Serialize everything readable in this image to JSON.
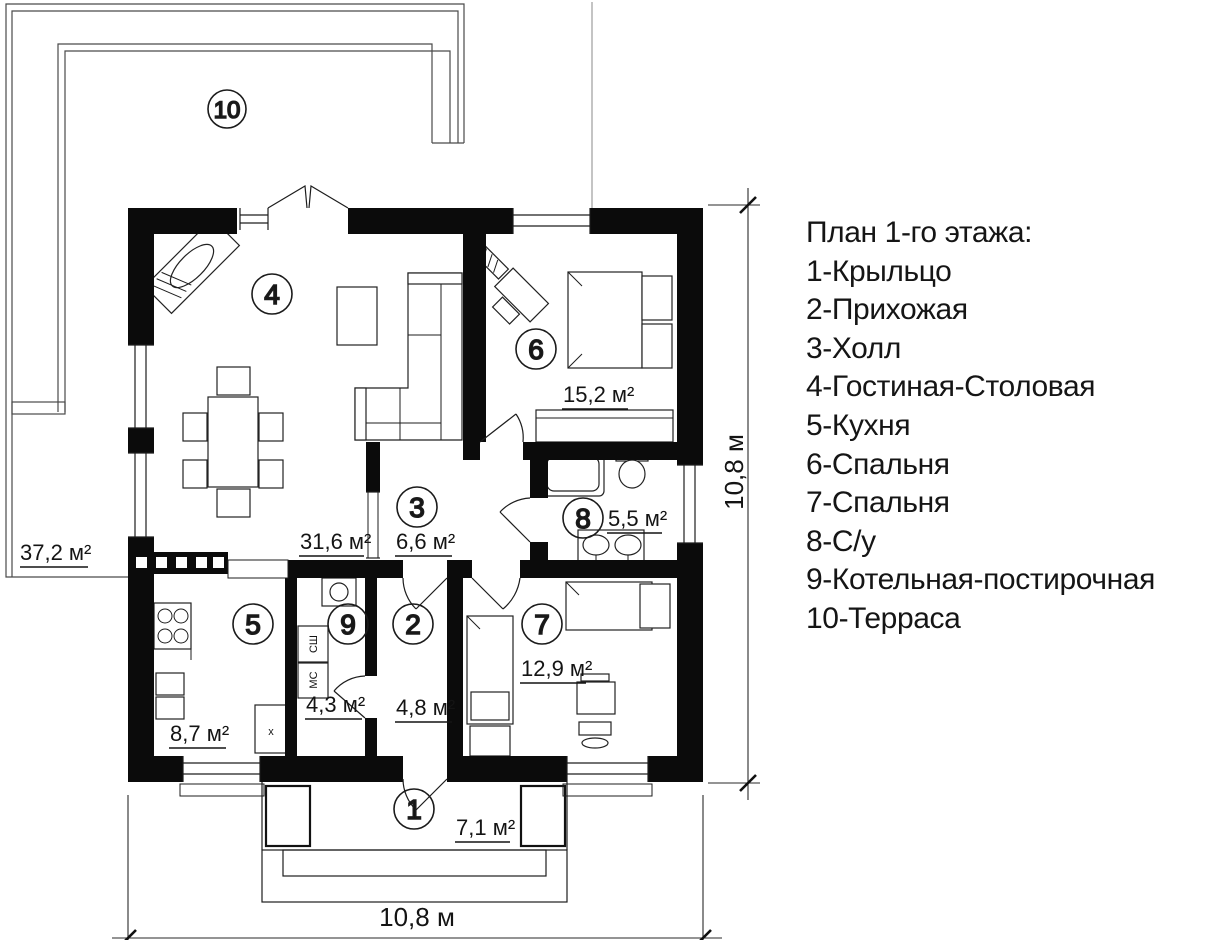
{
  "legend": {
    "title": "План 1-го этажа:",
    "items": [
      "1-Крыльцо",
      "2-Прихожая",
      "3-Холл",
      "4-Гостиная-Столовая",
      "5-Кухня",
      "6-Спальня",
      "7-Спальня",
      "8-С/у",
      "9-Котельная-постирочная",
      "10-Терраса"
    ]
  },
  "rooms": [
    {
      "number": "1",
      "name": "Крыльцо",
      "area": "7,1 м²"
    },
    {
      "number": "2",
      "name": "Прихожая",
      "area": "4,8 м²"
    },
    {
      "number": "3",
      "name": "Холл",
      "area": "6,6 м²"
    },
    {
      "number": "4",
      "name": "Гостиная-Столовая",
      "area": "31,6 м²"
    },
    {
      "number": "5",
      "name": "Кухня",
      "area": "8,7 м²"
    },
    {
      "number": "6",
      "name": "Спальня",
      "area": "15,2 м²"
    },
    {
      "number": "7",
      "name": "Спальня",
      "area": "12,9 м²"
    },
    {
      "number": "8",
      "name": "С/у",
      "area": "5,5 м²"
    },
    {
      "number": "9",
      "name": "Котельная-постирочная",
      "area": "4,3 м²"
    },
    {
      "number": "10",
      "name": "Терраса",
      "area": "37,2 м²"
    }
  ],
  "dimensions": {
    "width": "10,8 м",
    "height": "10,8 м"
  },
  "appliances": {
    "dryer": "СШ",
    "washer": "МС",
    "sink_marker": "x"
  },
  "colors": {
    "walls": "#0b0b0b",
    "lines": "#1d1d1d",
    "background": "#ffffff"
  }
}
